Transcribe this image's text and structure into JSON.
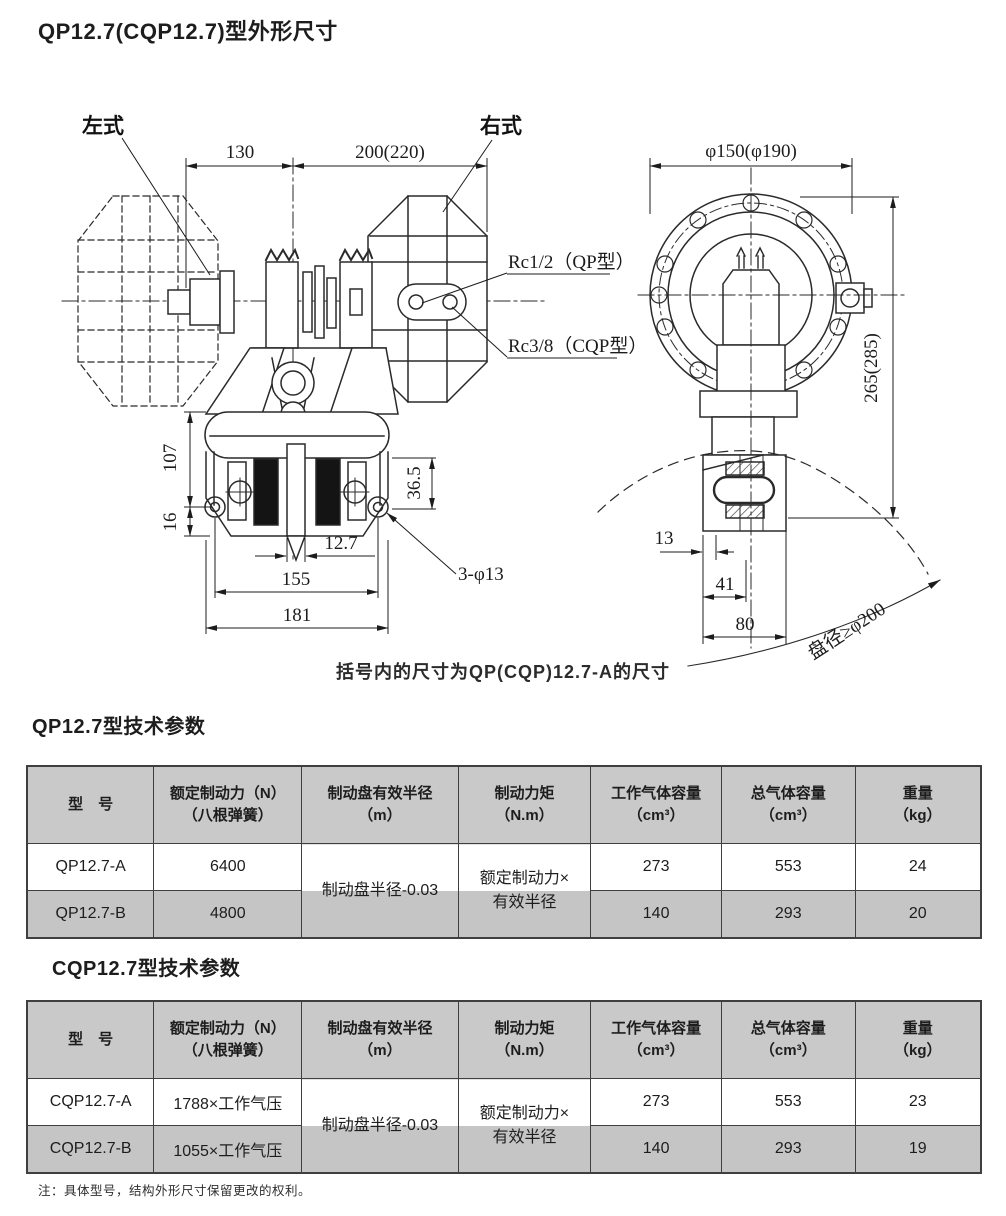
{
  "colors": {
    "header-bg": "#c9c9c9",
    "row-alt-bg": "#c5c5c5",
    "table-border": "#3f3f3f",
    "ink": "#1d1d1d"
  },
  "page": {
    "title": "QP12.7(CQP12.7)型外形尺寸",
    "drawing_caption": "括号内的尺寸为QP(CQP)12.7-A的尺寸",
    "footnote": "注：具体型号，结构外形尺寸保留更改的权利。"
  },
  "drawing": {
    "left_type_label": "左式",
    "right_type_label": "右式",
    "rc_qp_label": "Rc1/2（QP型）",
    "rc_cqp_label": "Rc3/8（CQP型）",
    "disc_diameter_label": "盘径≥φ200",
    "dim_130": "130",
    "dim_200_220": "200(220)",
    "dim_phi150": "φ150(φ190)",
    "dim_265_285": "265(285)",
    "dim_107": "107",
    "dim_16": "16",
    "dim_36_5": "36.5",
    "dim_12_7": "12.7",
    "dim_155": "155",
    "dim_181": "181",
    "dim_3_phi13": "3-φ13",
    "dim_13": "13",
    "dim_41": "41",
    "dim_80": "80"
  },
  "table_qp": {
    "heading": "QP12.7型技术参数",
    "col_model": "型　号",
    "col_force_1": "额定制动力（N）",
    "col_force_2": "（八根弹簧）",
    "col_radius_1": "制动盘有效半径",
    "col_radius_2": "（m）",
    "col_torque_1": "制动力矩",
    "col_torque_2": "（N.m）",
    "col_workvol_1": "工作气体容量",
    "col_workvol_2": "（cm³）",
    "col_totalvol_1": "总气体容量",
    "col_totalvol_2": "（cm³）",
    "col_weight_1": "重量",
    "col_weight_2": "（kg）",
    "radius_value": "制动盘半径-0.03",
    "torque_value_1": "额定制动力×",
    "torque_value_2": "有效半径",
    "row_a": {
      "model": "QP12.7-A",
      "force": "6400",
      "work_vol": "273",
      "total_vol": "553",
      "weight": "24"
    },
    "row_b": {
      "model": "QP12.7-B",
      "force": "4800",
      "work_vol": "140",
      "total_vol": "293",
      "weight": "20"
    }
  },
  "table_cqp": {
    "heading": "CQP12.7型技术参数",
    "col_model": "型　号",
    "col_force_1": "额定制动力（N）",
    "col_force_2": "（八根弹簧）",
    "col_radius_1": "制动盘有效半径",
    "col_radius_2": "（m）",
    "col_torque_1": "制动力矩",
    "col_torque_2": "（N.m）",
    "col_workvol_1": "工作气体容量",
    "col_workvol_2": "（cm³）",
    "col_totalvol_1": "总气体容量",
    "col_totalvol_2": "（cm³）",
    "col_weight_1": "重量",
    "col_weight_2": "（kg）",
    "radius_value": "制动盘半径-0.03",
    "torque_value_1": "额定制动力×",
    "torque_value_2": "有效半径",
    "row_a": {
      "model": "CQP12.7-A",
      "force": "1788×工作气压",
      "work_vol": "273",
      "total_vol": "553",
      "weight": "23"
    },
    "row_b": {
      "model": "CQP12.7-B",
      "force": "1055×工作气压",
      "work_vol": "140",
      "total_vol": "293",
      "weight": "19"
    }
  }
}
